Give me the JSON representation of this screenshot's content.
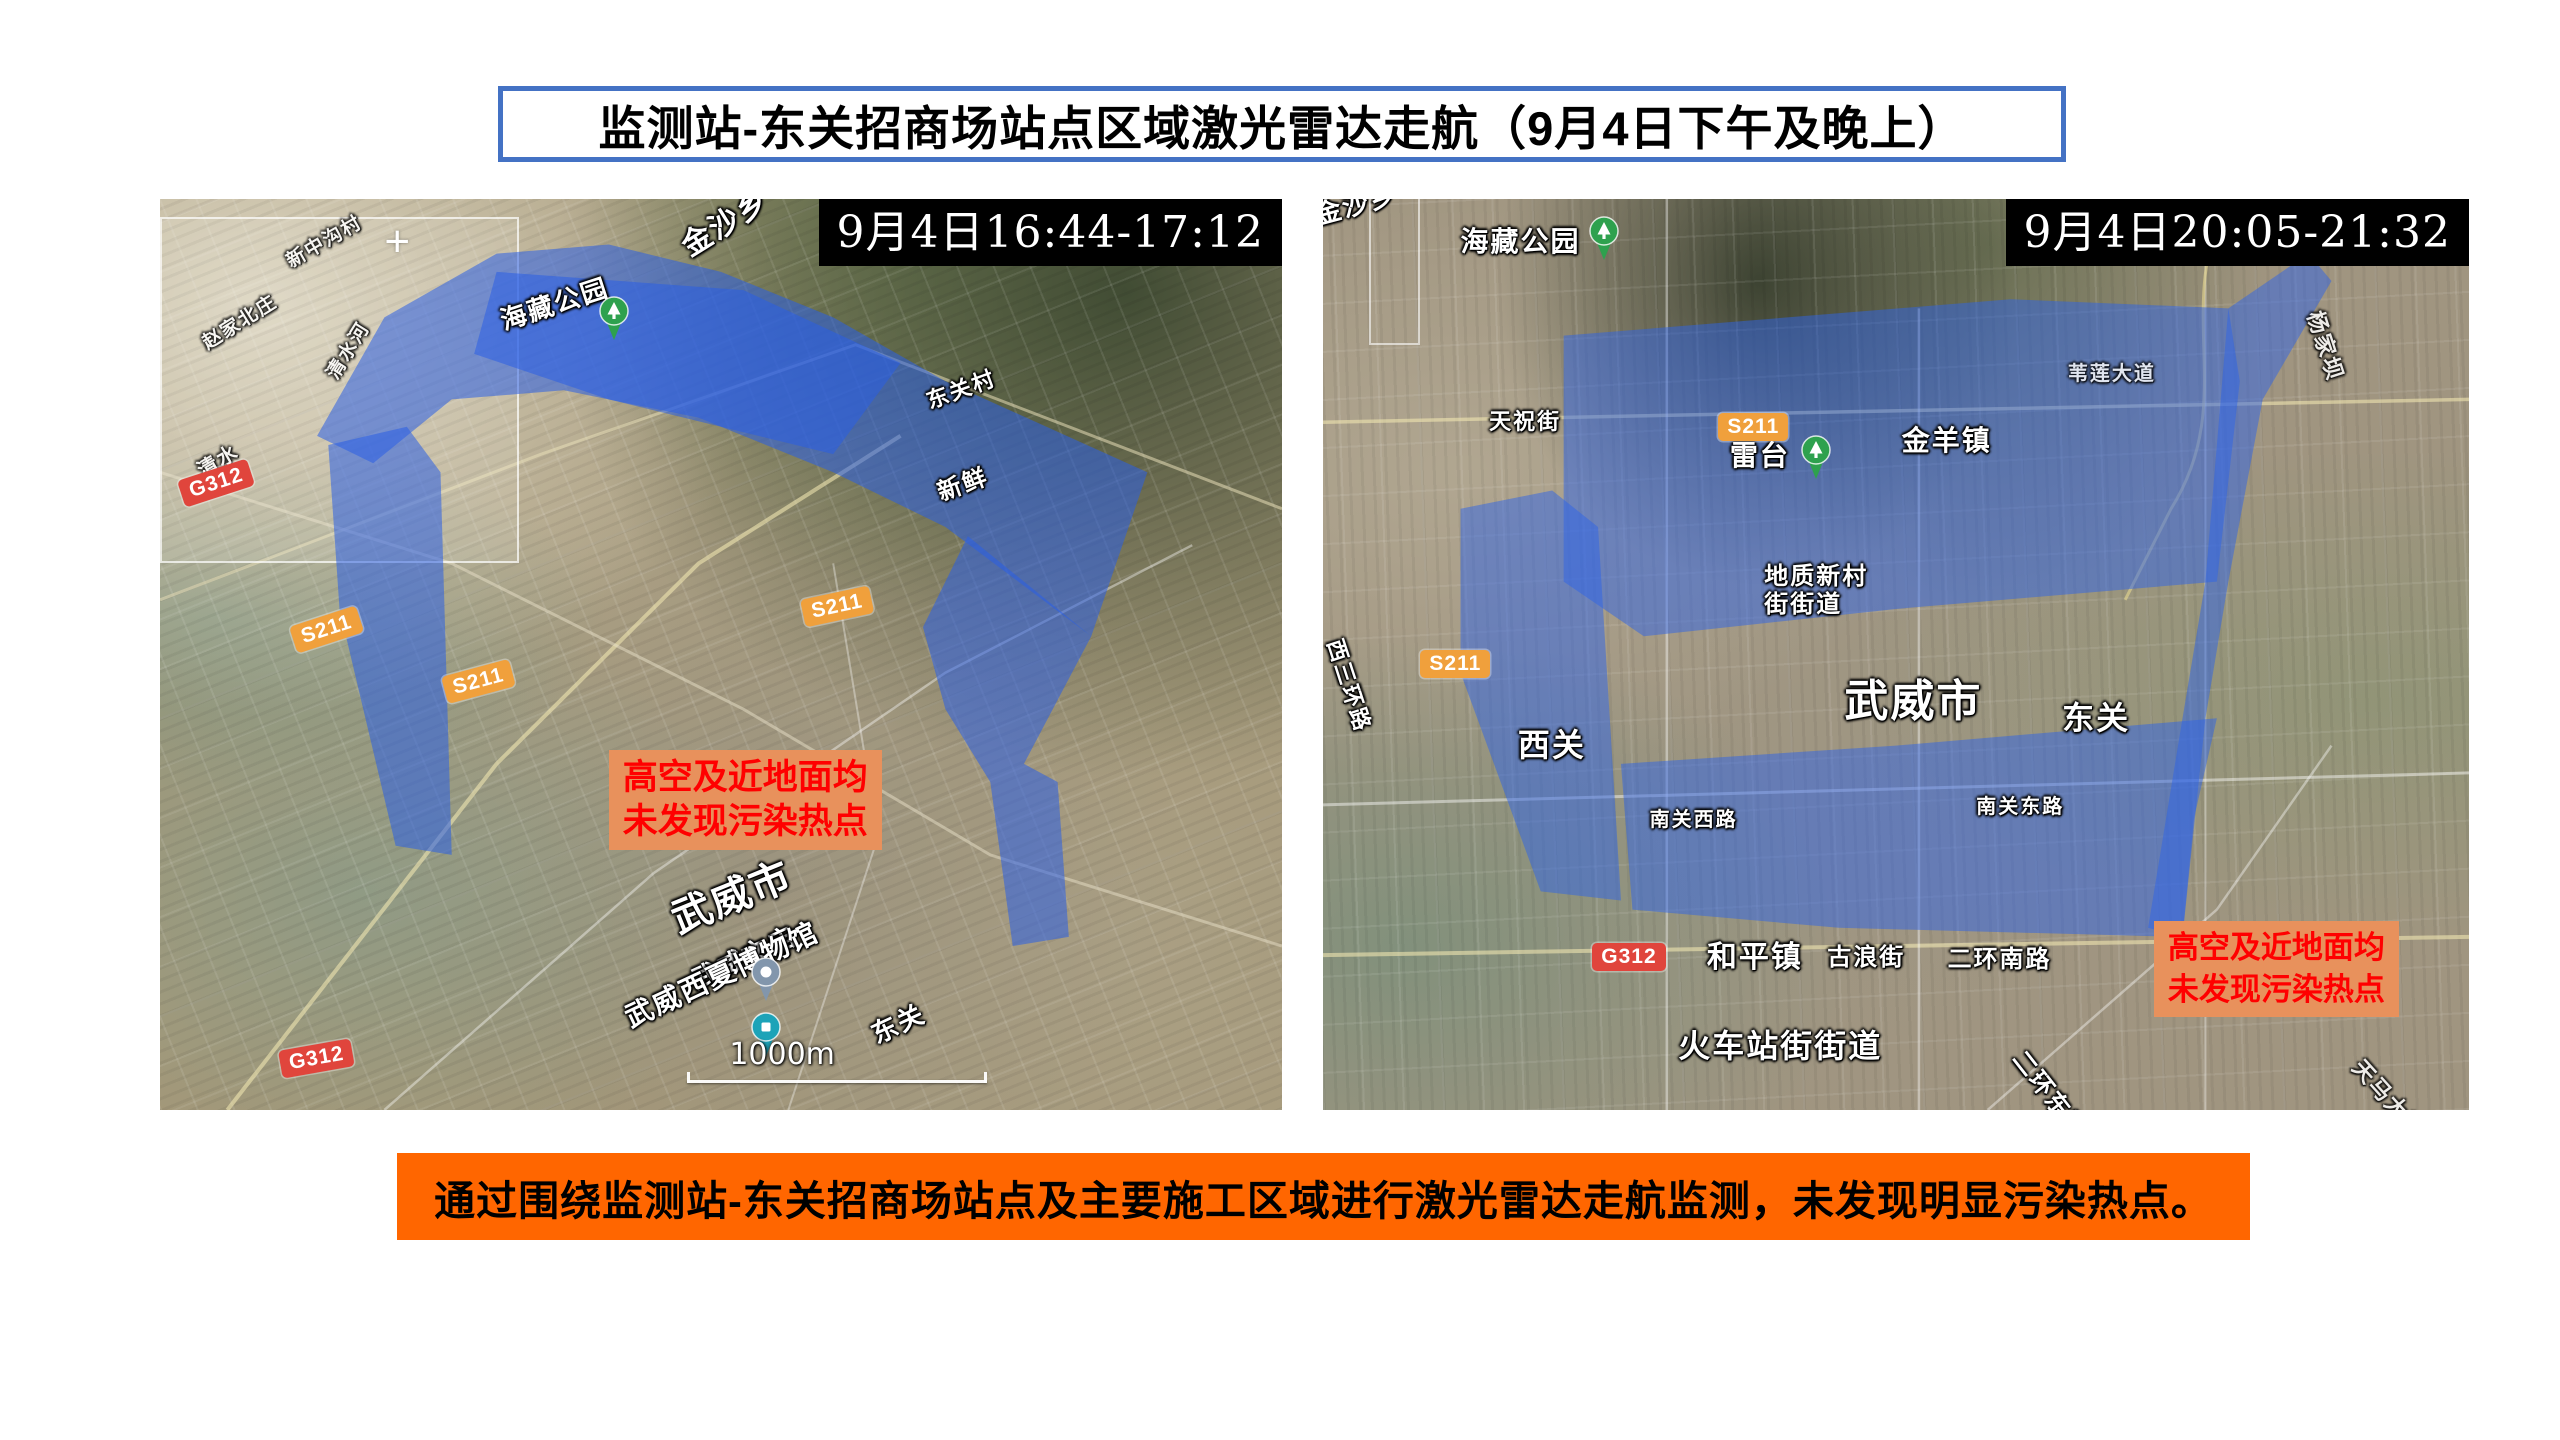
{
  "title": {
    "text": "监测站-东关招商场站点区域激光雷达走航（9月4日下午及晚上）",
    "border_color": "#4472C4"
  },
  "banner": {
    "text": "通过围绕监测站-东关招商场站点及主要施工区域进行激光雷达走航监测，未发现明显污染热点。",
    "bg_color": "#FF6600",
    "text_color": "#000000"
  },
  "annotation_style": {
    "bg_color": "#E8915C",
    "text_color": "#FF0000"
  },
  "road_badge_colors": {
    "national": "#E0453C",
    "provincial": "#F0A03C"
  },
  "maps": {
    "left": {
      "timestamp": "9月4日16:44-17:12",
      "annotation": {
        "line1": "高空及近地面均",
        "line2": "未发现污染热点"
      },
      "scale_label": "1000m",
      "overlay_color": "#2A5FE6",
      "overlay_opacity": 0.55,
      "overlay_polygons": [
        "14,26 20,13 30,6 40,5 50,8 60,13 70,20 88,30 83,48 70,36 60,30 48,24 36,21 26,22 19,29",
        "30,8 52,10 66,18 60,28 40,22 28,17",
        "72,37 83,48 80,55 77,62 80,64 81,81 76,82 74,64 70,56 68,47",
        "15,27 22,25 25,30 26,72 21,71 16,45"
      ],
      "roads": [
        {
          "d": "M0,44 L34,28 L62,16 L100,34",
          "c": "#e8dfb8",
          "w": 3,
          "o": 0.55
        },
        {
          "d": "M6,100 L30,62 L48,40 L66,26",
          "c": "#f0e6b0",
          "w": 4,
          "o": 0.6
        },
        {
          "d": "M0,30 L26,40 L52,56 L74,72 L100,82",
          "c": "#e8e0c8",
          "w": 3,
          "o": 0.5
        },
        {
          "d": "M20,100 L44,74 L70,52 L92,38",
          "c": "#ffffff",
          "w": 2.5,
          "o": 0.4
        },
        {
          "d": "M56,100 L64,70 L60,40",
          "c": "#ffffff",
          "w": 2,
          "o": 0.35
        }
      ],
      "labels": [
        {
          "text": "金沙乡",
          "x": 46,
          "y": 4,
          "rot": -32,
          "size": 30
        },
        {
          "text": "新中沟村",
          "x": 11,
          "y": 6,
          "rot": -30,
          "size": 19,
          "dim": true
        },
        {
          "text": "赵家北庄",
          "x": 3.5,
          "y": 15,
          "rot": -32,
          "size": 19,
          "dim": true
        },
        {
          "text": "清水河",
          "x": 14.5,
          "y": 19,
          "rot": -58,
          "size": 19,
          "dim": true
        },
        {
          "text": "清水",
          "x": 3,
          "y": 29,
          "rot": -30,
          "size": 20,
          "dim": true
        },
        {
          "text": "海藏公园",
          "x": 30,
          "y": 12,
          "rot": -18,
          "size": 26
        },
        {
          "text": "东关村",
          "x": 68,
          "y": 21,
          "rot": -20,
          "size": 22
        },
        {
          "text": "新鲜",
          "x": 69,
          "y": 31,
          "rot": -20,
          "size": 24
        },
        {
          "text": "武威市",
          "x": 45,
          "y": 77,
          "rot": -22,
          "size": 40
        },
        {
          "text": "武威文庙",
          "x": 47,
          "y": 84.5,
          "rot": -25,
          "size": 26
        },
        {
          "text": "武威西夏博物馆",
          "x": 41,
          "y": 88.5,
          "rot": -25,
          "size": 28
        },
        {
          "text": "东关",
          "x": 63,
          "y": 90.5,
          "rot": -25,
          "size": 26
        }
      ],
      "badges": [
        {
          "code": "G312",
          "x": 1.5,
          "y": 31,
          "rot": -18,
          "color": "#E0453C"
        },
        {
          "code": "S211",
          "x": 11.5,
          "y": 47,
          "rot": -18,
          "color": "#F0A03C"
        },
        {
          "code": "S211",
          "x": 25,
          "y": 52.5,
          "rot": -15,
          "color": "#F0A03C"
        },
        {
          "code": "S211",
          "x": 57,
          "y": 44,
          "rot": -12,
          "color": "#F0A03C"
        },
        {
          "code": "G312",
          "x": 10.5,
          "y": 93.5,
          "rot": -10,
          "color": "#E0453C"
        }
      ],
      "pins": [
        {
          "type": "park",
          "x": 40.5,
          "y": 16.3
        },
        {
          "type": "station",
          "x": 54,
          "y": 88.8
        },
        {
          "type": "poi",
          "x": 54,
          "y": 94.8
        }
      ]
    },
    "right": {
      "timestamp": "9月4日20:05-21:32",
      "annotation": {
        "line1": "高空及近地面均",
        "line2": "未发现污染热点"
      },
      "overlay_color": "#2E63E8",
      "overlay_opacity": 0.5,
      "overlay_polygons": [
        "21,15 60,11 79,12 80,20 78,42 50,45 28,48 21,42",
        "26,62 50,60 78,57 76,68 75,81 45,80 27,78",
        "12,34 20,32 24,36 26,77 19,76 12,52",
        "79,12 86,6 88,9 82,22 79,42 77,57 75,81 72,80 75,57 77,42"
      ],
      "roads": [
        {
          "d": "M0,24.5 L100,22",
          "c": "#f0e6b0",
          "w": 3.5,
          "o": 0.6
        },
        {
          "d": "M0,66.5 L100,63",
          "c": "#ffffff",
          "w": 3,
          "o": 0.45
        },
        {
          "d": "M0,83 L100,81",
          "c": "#f0e6b0",
          "w": 4,
          "o": 0.6
        },
        {
          "d": "M30,0 L30,100",
          "c": "#ffffff",
          "w": 2.5,
          "o": 0.4
        },
        {
          "d": "M52,12 L52,100",
          "c": "#ffffff",
          "w": 2.5,
          "o": 0.4
        },
        {
          "d": "M77,0 L77,100",
          "c": "#ffffff",
          "w": 2,
          "o": 0.35
        },
        {
          "d": "M79,0 C74,12 80,22 74,34 L70,44",
          "c": "#e8d890",
          "w": 3,
          "o": 0.6
        },
        {
          "d": "M58,100 L78,78 L88,60",
          "c": "#ffffff",
          "w": 2.5,
          "o": 0.4
        }
      ],
      "labels": [
        {
          "text": "金沙乡",
          "x": -1,
          "y": 0.3,
          "rot": -15,
          "size": 26
        },
        {
          "text": "海藏公园",
          "x": 12,
          "y": 3,
          "rot": 0,
          "size": 28
        },
        {
          "text": "天祝街",
          "x": 14.5,
          "y": 23,
          "rot": 0,
          "size": 22
        },
        {
          "text": "雷台",
          "x": 35.5,
          "y": 26.5,
          "rot": 0,
          "size": 28
        },
        {
          "text": "金羊镇",
          "x": 50.5,
          "y": 24.8,
          "rot": 0,
          "size": 28
        },
        {
          "text": "杨家坝",
          "x": 87.5,
          "y": 12,
          "rot": 72,
          "size": 22,
          "dim": true
        },
        {
          "text": "苇莲大道",
          "x": 65,
          "y": 18,
          "rot": 0,
          "size": 20,
          "dim": true
        },
        {
          "lines": [
            "地质新村",
            "街街道"
          ],
          "x": 38.5,
          "y": 40,
          "rot": 0,
          "size": 24
        },
        {
          "text": "武威市",
          "x": 45.5,
          "y": 52.5,
          "rot": 0,
          "size": 44
        },
        {
          "text": "东关",
          "x": 64.5,
          "y": 55,
          "rot": 0,
          "size": 32
        },
        {
          "text": "西关",
          "x": 17,
          "y": 58,
          "rot": 0,
          "size": 32
        },
        {
          "text": "南关西路",
          "x": 28.5,
          "y": 67,
          "rot": 0,
          "size": 20
        },
        {
          "text": "南关东路",
          "x": 57,
          "y": 65.5,
          "rot": 0,
          "size": 20
        },
        {
          "text": "西三环路",
          "x": 2,
          "y": 48,
          "rot": 72,
          "size": 22
        },
        {
          "text": "和平镇",
          "x": 33.5,
          "y": 81.5,
          "rot": 0,
          "size": 30
        },
        {
          "text": "古浪街",
          "x": 44,
          "y": 81.8,
          "rot": 0,
          "size": 24
        },
        {
          "text": "二环南路",
          "x": 54.5,
          "y": 82,
          "rot": 0,
          "size": 24
        },
        {
          "text": "火车站街街道",
          "x": 31,
          "y": 91,
          "rot": 0,
          "size": 32
        },
        {
          "text": "二环东路",
          "x": 61.5,
          "y": 93,
          "rot": 52,
          "size": 24
        },
        {
          "text": "天马大道",
          "x": 91,
          "y": 94,
          "rot": 48,
          "size": 22,
          "dim": true
        }
      ],
      "badges": [
        {
          "code": "S211",
          "x": 34.5,
          "y": 23.5,
          "rot": 0,
          "color": "#F0A03C"
        },
        {
          "code": "S211",
          "x": 8.5,
          "y": 49.5,
          "rot": 0,
          "color": "#F0A03C"
        },
        {
          "code": "G312",
          "x": 23.5,
          "y": 81.7,
          "rot": 0,
          "color": "#E0453C"
        }
      ],
      "pins": [
        {
          "type": "park",
          "x": 24.5,
          "y": 7.5
        },
        {
          "type": "park",
          "x": 43,
          "y": 31.5
        }
      ]
    }
  }
}
